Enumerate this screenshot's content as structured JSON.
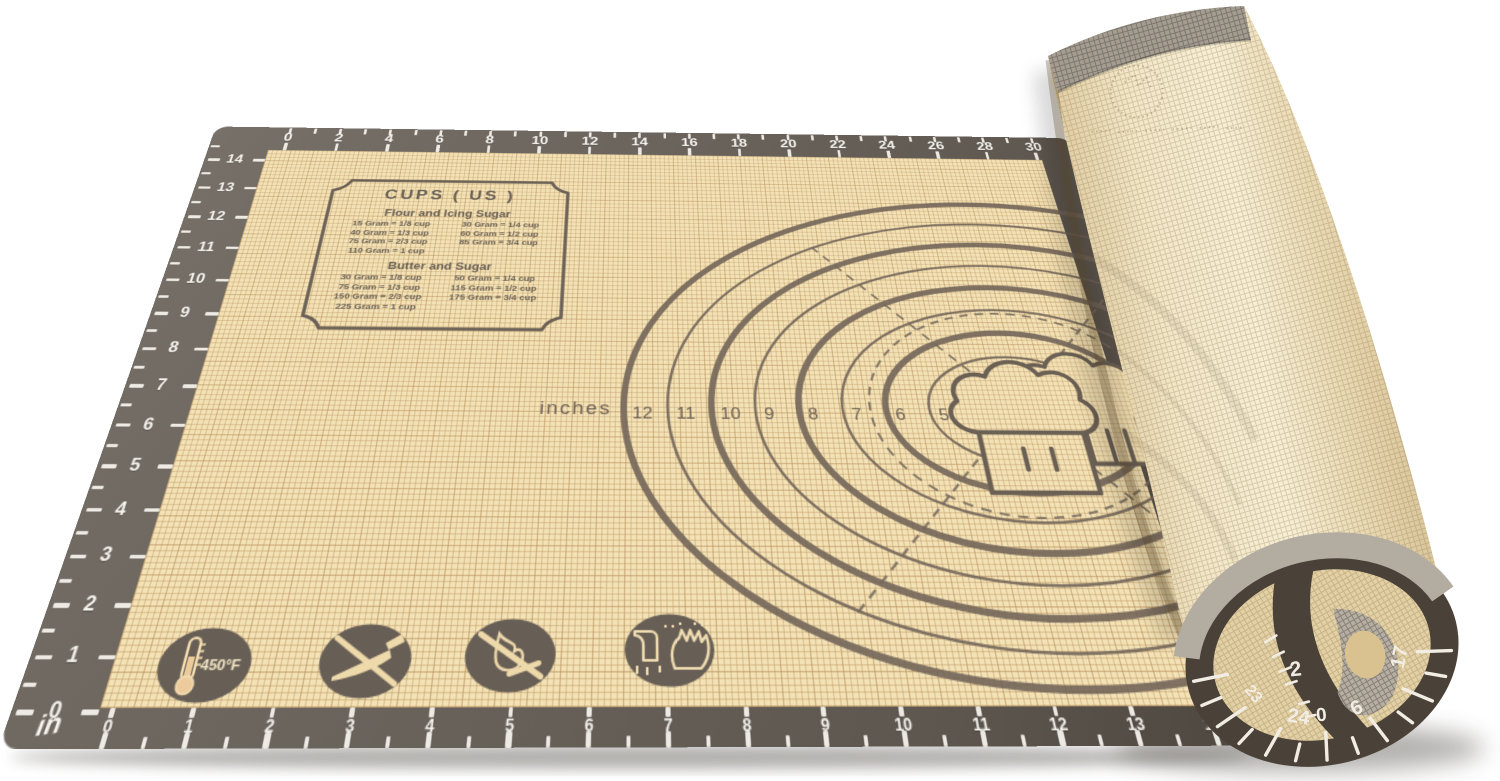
{
  "colors": {
    "background": "#ffffff",
    "mat_border": "#6a635c",
    "mat_surface": "#f3e2b6",
    "grid_line": "#d9bd8a",
    "marking": "#6b6054",
    "tick_white": "#f7f4ee",
    "roll_light": "#f7eed4",
    "roll_dark": "#c9b488",
    "roll_gray_band": "#a59d92",
    "cap_rim": "#4a4238",
    "cap_face": "#e3d0a4",
    "cap_gray": "#b3aca1"
  },
  "conversion_chart": {
    "title": "CUPS ( US )",
    "sections": [
      {
        "heading": "Flour and Icing Sugar",
        "rows": [
          [
            "15 Gram = 1/8 cup",
            "30 Gram = 1/4 cup"
          ],
          [
            "40 Gram = 1/3 cup",
            "60 Gram = 1/2 cup"
          ],
          [
            "75 Gram = 2/3 cup",
            "85 Gram = 3/4 cup"
          ],
          [
            "110 Gram =   1 cup",
            ""
          ]
        ]
      },
      {
        "heading": "Butter and Sugar",
        "rows": [
          [
            "30 Gram = 1/8 cup",
            "50 Gram = 1/4 cup"
          ],
          [
            "75 Gram = 1/3 cup",
            "115 Gram = 1/2 cup"
          ],
          [
            "150 Gram = 2/3 cup",
            "175 Gram = 3/4 cup"
          ],
          [
            "225 Gram =    1 cup",
            ""
          ]
        ]
      }
    ]
  },
  "rulers": {
    "top": {
      "labels": [
        0,
        2,
        4,
        6,
        8,
        10,
        12,
        14,
        16,
        18,
        20,
        22,
        24,
        26,
        28,
        30
      ]
    },
    "left": {
      "labels": [
        14,
        13,
        12,
        11,
        10,
        9,
        8,
        7,
        6,
        5,
        4,
        3,
        2,
        1,
        0
      ]
    },
    "bottom": {
      "unit_label": "in",
      "labels": [
        0,
        1,
        2,
        3,
        4,
        5,
        6,
        7,
        8,
        9,
        10,
        11,
        12,
        13,
        14
      ]
    },
    "roll_end": {
      "rim_labels": [
        "23",
        "24",
        "6",
        "17"
      ],
      "inner_labels": [
        "2",
        "0"
      ]
    }
  },
  "circle_guide": {
    "label": "inches",
    "diameters": [
      12,
      11,
      10,
      9,
      8,
      7,
      6,
      5
    ]
  },
  "icons": [
    {
      "name": "thermometer-icon",
      "label": "450°F"
    },
    {
      "name": "no-knife-icon"
    },
    {
      "name": "no-flame-icon"
    },
    {
      "name": "hand-wash-icon"
    }
  ]
}
